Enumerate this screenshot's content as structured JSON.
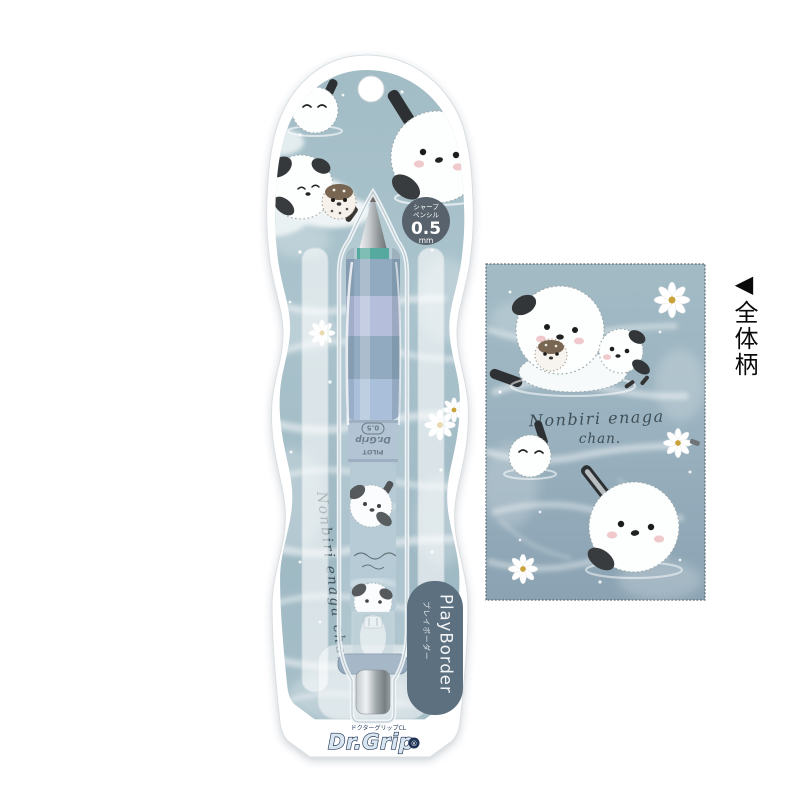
{
  "product": "Dr.Grip PlayBorder mechanical pencil blister package (Shimaenaga water pattern)",
  "colors": {
    "water_card": "#a7c0c9",
    "water_panel_top": "#a2bbc5",
    "water_panel_bottom": "#8aa2b2",
    "badge_bg": "#57626c",
    "pill_bg": "#5d7080",
    "grip_steel": "#7e9ab2",
    "grip_periwinkle": "#a9b3d3",
    "grip_light": "#9cb4d2",
    "tip_ring_teal": "#35998a",
    "logo_navy": "#1d3254",
    "ink": "#3e4f57"
  },
  "badge": {
    "line1": "シャープ",
    "line2": "ペンシル",
    "value": "0.5",
    "unit": "mm"
  },
  "pill": {
    "en": "PlayBorder",
    "ja": "プレイボーダー"
  },
  "logo": {
    "sub": "ドクターグリップCL",
    "name": "Dr.Grip",
    "mark": "®"
  },
  "barrel": {
    "maker": "PILOT",
    "brand": "Dr.Grip",
    "size": "0.5"
  },
  "script": {
    "line1": "Nonbiri enaga",
    "line2": "chan.",
    "vertical": "Nonbiri enaga chan"
  },
  "panel_label": "◀全体柄"
}
